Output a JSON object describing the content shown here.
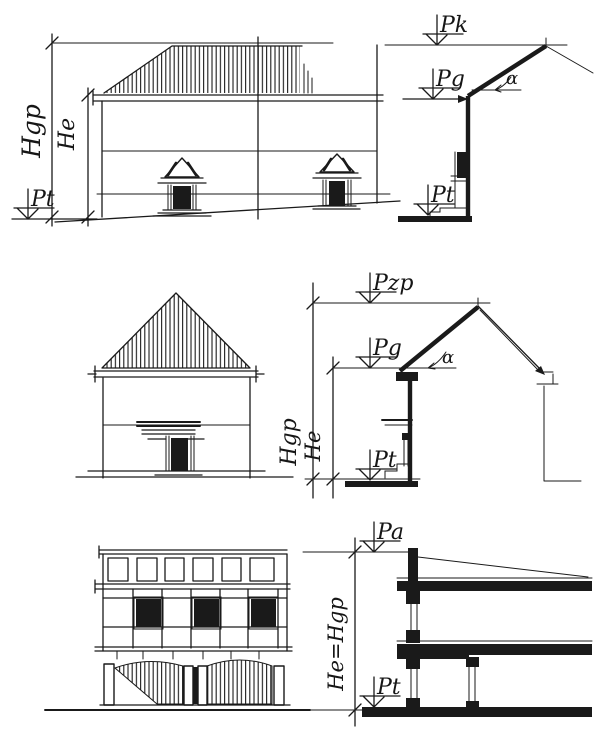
{
  "figure": {
    "kind": "hand-drawn architectural height-definition diagram",
    "ink_color": "#1a1a1a",
    "paper_color": "#ffffff",
    "rows": [
      "hipped-roof building elevation with eaves section",
      "gable-roof building elevation with ridge section",
      "flat-roof multi-storey building elevation with section"
    ]
  },
  "labels": {
    "top_section": {
      "ridge_level": "Pk",
      "eaves_level": "Pg",
      "section_ground_level": "Pt",
      "elevation_ground_level": "Pt",
      "overall_height": "Hgp",
      "eaves_height": "He",
      "roof_angle": "α"
    },
    "middle_section": {
      "ridge_level": "Pzp",
      "eaves_level": "Pg",
      "ground_level": "Pt",
      "overall_height": "Hgp",
      "eaves_height": "He",
      "roof_angle": "α"
    },
    "bottom_section": {
      "parapet_level": "Pa",
      "ground_level": "Pt",
      "height_equation": "He=Hgp"
    }
  }
}
